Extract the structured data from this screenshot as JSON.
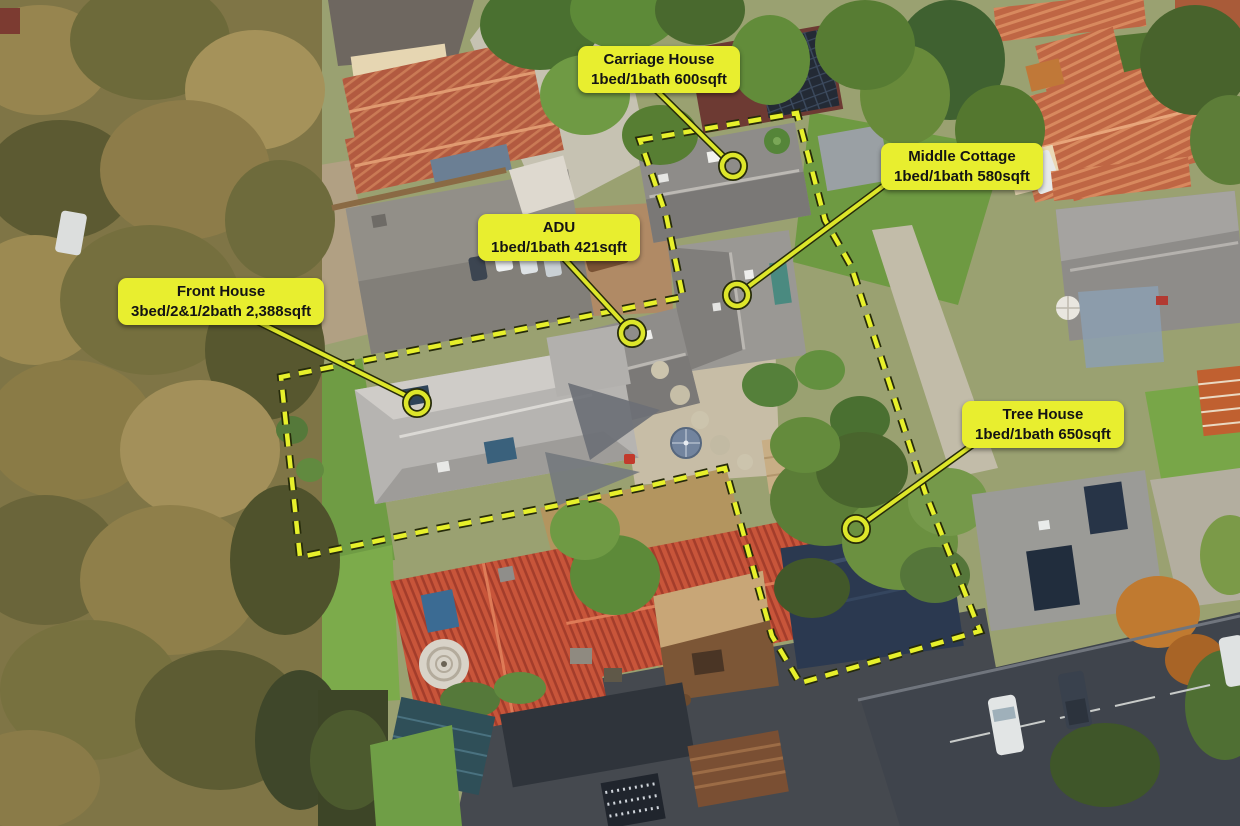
{
  "colors": {
    "label_bg": "#e8ee2f",
    "label_text": "#141414",
    "annotation_stroke": "#dde62a",
    "annotation_outline": "#262b0a",
    "boundary_dash": "#e7f02b",
    "boundary_outline": "#262b0a"
  },
  "boundary": {
    "dash": [
      13,
      9
    ],
    "points": [
      [
        640,
        140
      ],
      [
        797,
        113
      ],
      [
        825,
        220
      ],
      [
        851,
        266
      ],
      [
        925,
        492
      ],
      [
        980,
        631
      ],
      [
        800,
        683
      ],
      [
        772,
        636
      ],
      [
        725,
        468
      ],
      [
        640,
        488
      ],
      [
        540,
        509
      ],
      [
        430,
        530
      ],
      [
        300,
        557
      ],
      [
        281,
        377
      ],
      [
        683,
        297
      ],
      [
        666,
        215
      ]
    ]
  },
  "callouts": [
    {
      "id": "carriage-house",
      "title": "Carriage House",
      "details": "1bed/1bath 600sqft",
      "label": {
        "x": 578,
        "y": 46,
        "w": 142,
        "h": 40
      },
      "line": {
        "x1": 652,
        "y1": 86,
        "x2": 726,
        "y2": 159
      },
      "marker": {
        "x": 733,
        "y": 166,
        "r": 11
      }
    },
    {
      "id": "middle-cottage",
      "title": "Middle Cottage",
      "details": "1bed/1bath 580sqft",
      "label": {
        "x": 881,
        "y": 143,
        "w": 137,
        "h": 43
      },
      "line": {
        "x1": 886,
        "y1": 184,
        "x2": 745,
        "y2": 289
      },
      "marker": {
        "x": 737,
        "y": 295,
        "r": 11
      }
    },
    {
      "id": "adu",
      "title": "ADU",
      "details": "1bed/1bath 421sqft",
      "label": {
        "x": 478,
        "y": 214,
        "w": 143,
        "h": 40
      },
      "line": {
        "x1": 560,
        "y1": 254,
        "x2": 626,
        "y2": 326
      },
      "marker": {
        "x": 632,
        "y": 333,
        "r": 11
      }
    },
    {
      "id": "front-house",
      "title": "Front House",
      "details": "3bed/2&1/2bath 2,388sqft",
      "label": {
        "x": 118,
        "y": 278,
        "w": 168,
        "h": 40
      },
      "line": {
        "x1": 250,
        "y1": 318,
        "x2": 409,
        "y2": 397
      },
      "marker": {
        "x": 417,
        "y": 403,
        "r": 11
      }
    },
    {
      "id": "tree-house",
      "title": "Tree House",
      "details": "1bed/1bath 650sqft",
      "label": {
        "x": 962,
        "y": 401,
        "w": 150,
        "h": 40
      },
      "line": {
        "x1": 978,
        "y1": 441,
        "x2": 864,
        "y2": 523
      },
      "marker": {
        "x": 856,
        "y": 529,
        "r": 11
      }
    }
  ]
}
